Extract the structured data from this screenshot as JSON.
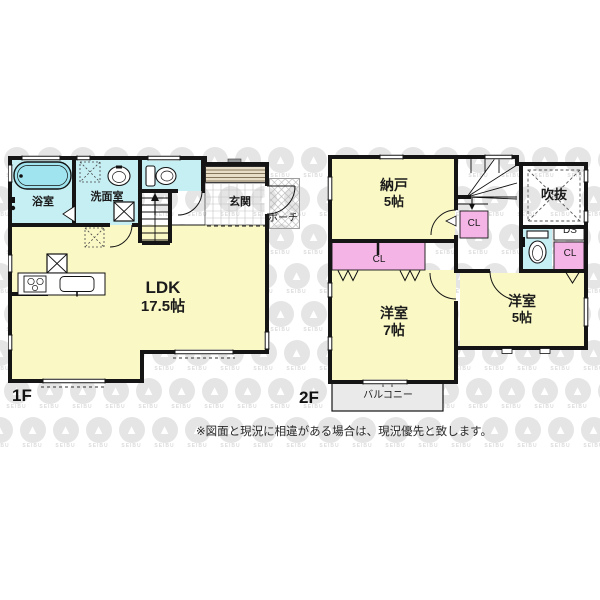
{
  "floors": {
    "f1": {
      "label": "1F",
      "rooms": {
        "bath": "浴室",
        "washroom": "洗面室",
        "entrance": "玄関",
        "porch": "ポーチ",
        "ldk_name": "LDK",
        "ldk_size": "17.5帖"
      }
    },
    "f2": {
      "label": "2F",
      "rooms": {
        "storage_name": "納戸",
        "storage_size": "5帖",
        "void_space": "吹抜",
        "closet_under_stairs": "CL",
        "closet_strip": "CL",
        "closet_right": "CL",
        "duct_space": "DS",
        "west7_name": "洋室",
        "west7_size": "7帖",
        "west5_name": "洋室",
        "west5_size": "5帖",
        "balcony": "バルコニー"
      }
    }
  },
  "footnote": "※図面と現況に相違がある場合は、現況優先と致します。",
  "watermark": {
    "label": "SEIBU"
  },
  "colors": {
    "room_yellow": "#FAF9C6",
    "water_cyan": "#C6EFF4",
    "tub_cyan": "#9FE4EE",
    "closet_pink": "#F4B4E6",
    "balcony_gray": "#EAEAEA",
    "wall": "#151515",
    "entry_band_tan": "#E9DFC8"
  }
}
